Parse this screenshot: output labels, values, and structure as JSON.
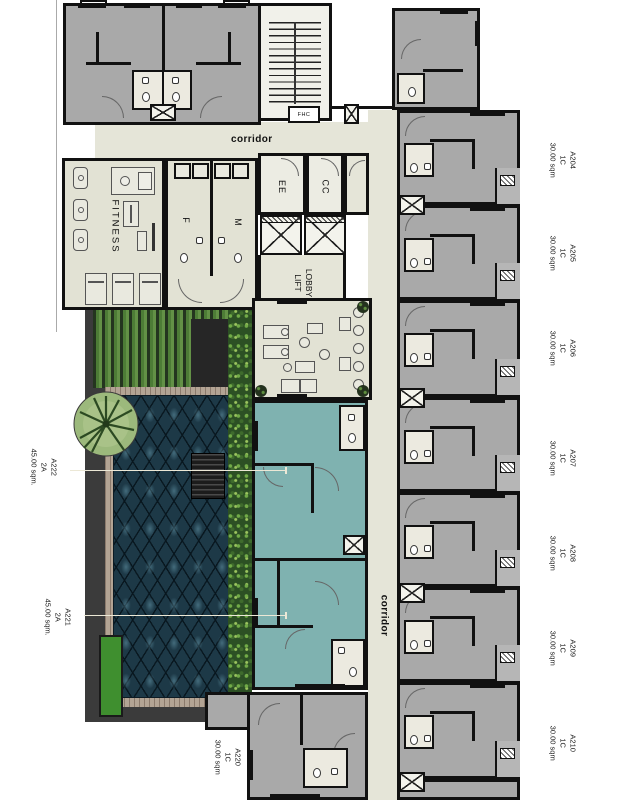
{
  "title": "Residential floor plan",
  "plan": {
    "corridor_horizontal": "corridor",
    "corridor_vertical": "corridor",
    "rooms": {
      "fitness": "FITNESS",
      "female_toilet": "F",
      "male_toilet": "M",
      "ee": "EE",
      "cc": "CC",
      "fhc": "FHC",
      "lift_lobby_line1": "LIFT",
      "lift_lobby_line2": "LOBBY"
    },
    "units_right": [
      {
        "name": "A204",
        "type": "1C",
        "area": "30.00 sqm"
      },
      {
        "name": "A205",
        "type": "1C",
        "area": "30.00 sqm"
      },
      {
        "name": "A206",
        "type": "1C",
        "area": "30.00 sqm"
      },
      {
        "name": "A207",
        "type": "1C",
        "area": "30.00 sqm"
      },
      {
        "name": "A208",
        "type": "1C",
        "area": "30.00 sqm"
      },
      {
        "name": "A209",
        "type": "1C",
        "area": "30.00 sqm"
      },
      {
        "name": "A210",
        "type": "1C",
        "area": "30.00 sqm"
      }
    ],
    "units_left": [
      {
        "name": "A222",
        "type": "2A",
        "area": "45.00 sqm."
      },
      {
        "name": "A221",
        "type": "2A",
        "area": "45.00 sqm."
      }
    ],
    "unit_bottom": {
      "name": "A220",
      "type": "1C",
      "area": "30.00 sqm"
    },
    "colors": {
      "wall": "#111111",
      "unit_gray": "#a9a9a9",
      "unit_teal": "#7fb2b0",
      "floor_beige": "#e5e5d8",
      "pool_dark": "#1d3947",
      "pool_diamond": "#3c6b7d",
      "deck_green": "#4d7c36",
      "hedge_green": "#2c5024",
      "grass_green": "#3f8f2f",
      "frame_dark": "#3b3b3b"
    }
  }
}
